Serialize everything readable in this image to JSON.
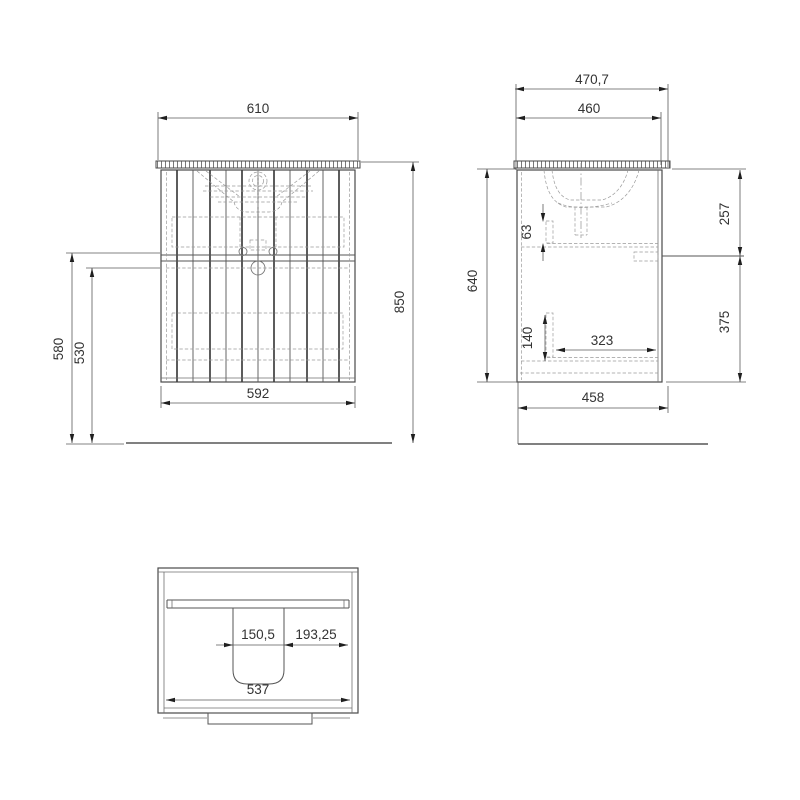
{
  "title": "Vanity cabinet technical drawing",
  "views": {
    "front": {
      "label": "front-view",
      "dims": {
        "counter_width": "610",
        "body_width": "592",
        "total_height": "850",
        "height_outer": "580",
        "height_inner": "530"
      }
    },
    "side": {
      "label": "side-view",
      "dims": {
        "counter_depth": "470,7",
        "body_depth_top": "460",
        "body_height": "640",
        "upper_front_height": "257",
        "lower_front_height": "375",
        "inner_gap_top": "63",
        "inner_gap_bottom": "140",
        "inner_depth": "323",
        "body_depth_bottom": "458"
      }
    },
    "plan": {
      "label": "plan-view",
      "dims": {
        "cutout_width": "150,5",
        "cutout_side_offset": "193,25",
        "inner_width": "537"
      }
    }
  }
}
